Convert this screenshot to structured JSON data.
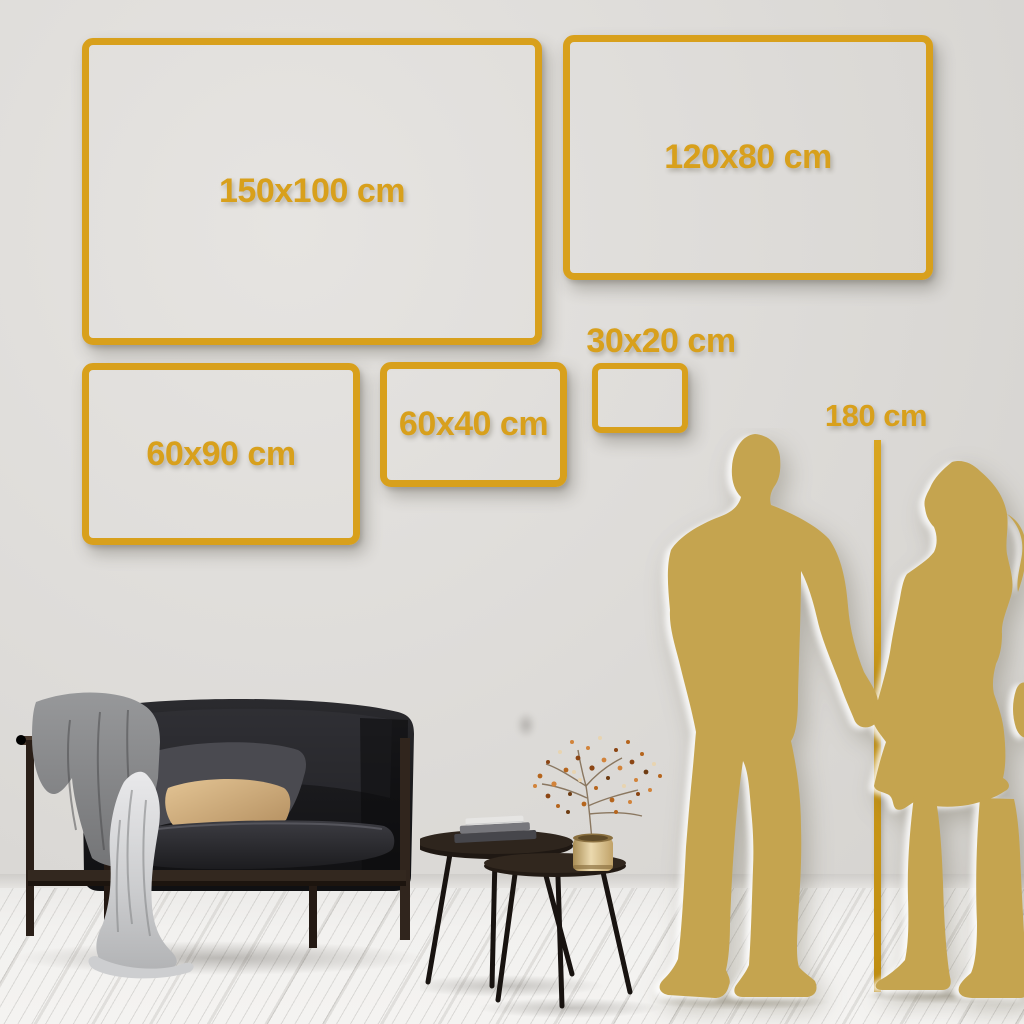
{
  "size_guide": {
    "frames": [
      {
        "id": "150x100",
        "label": "150x100 cm"
      },
      {
        "id": "120x80",
        "label": "120x80 cm"
      },
      {
        "id": "60x90",
        "label": "60x90 cm"
      },
      {
        "id": "60x40",
        "label": "60x40 cm"
      },
      {
        "id": "30x20",
        "label": "30x20 cm"
      }
    ],
    "height_reference": {
      "label": "180 cm"
    },
    "colors": {
      "frame_gold": "#D8A01C",
      "silhouette_gold": "#C5A44F",
      "height_line_gold": "#CE9B15",
      "wall_gray": "#DCDAD7",
      "floor_white": "#F1F0EE",
      "sofa_charcoal": "#17171A",
      "pillow_tan": "#D8B88C",
      "vase_brass": "#D9C498"
    }
  }
}
